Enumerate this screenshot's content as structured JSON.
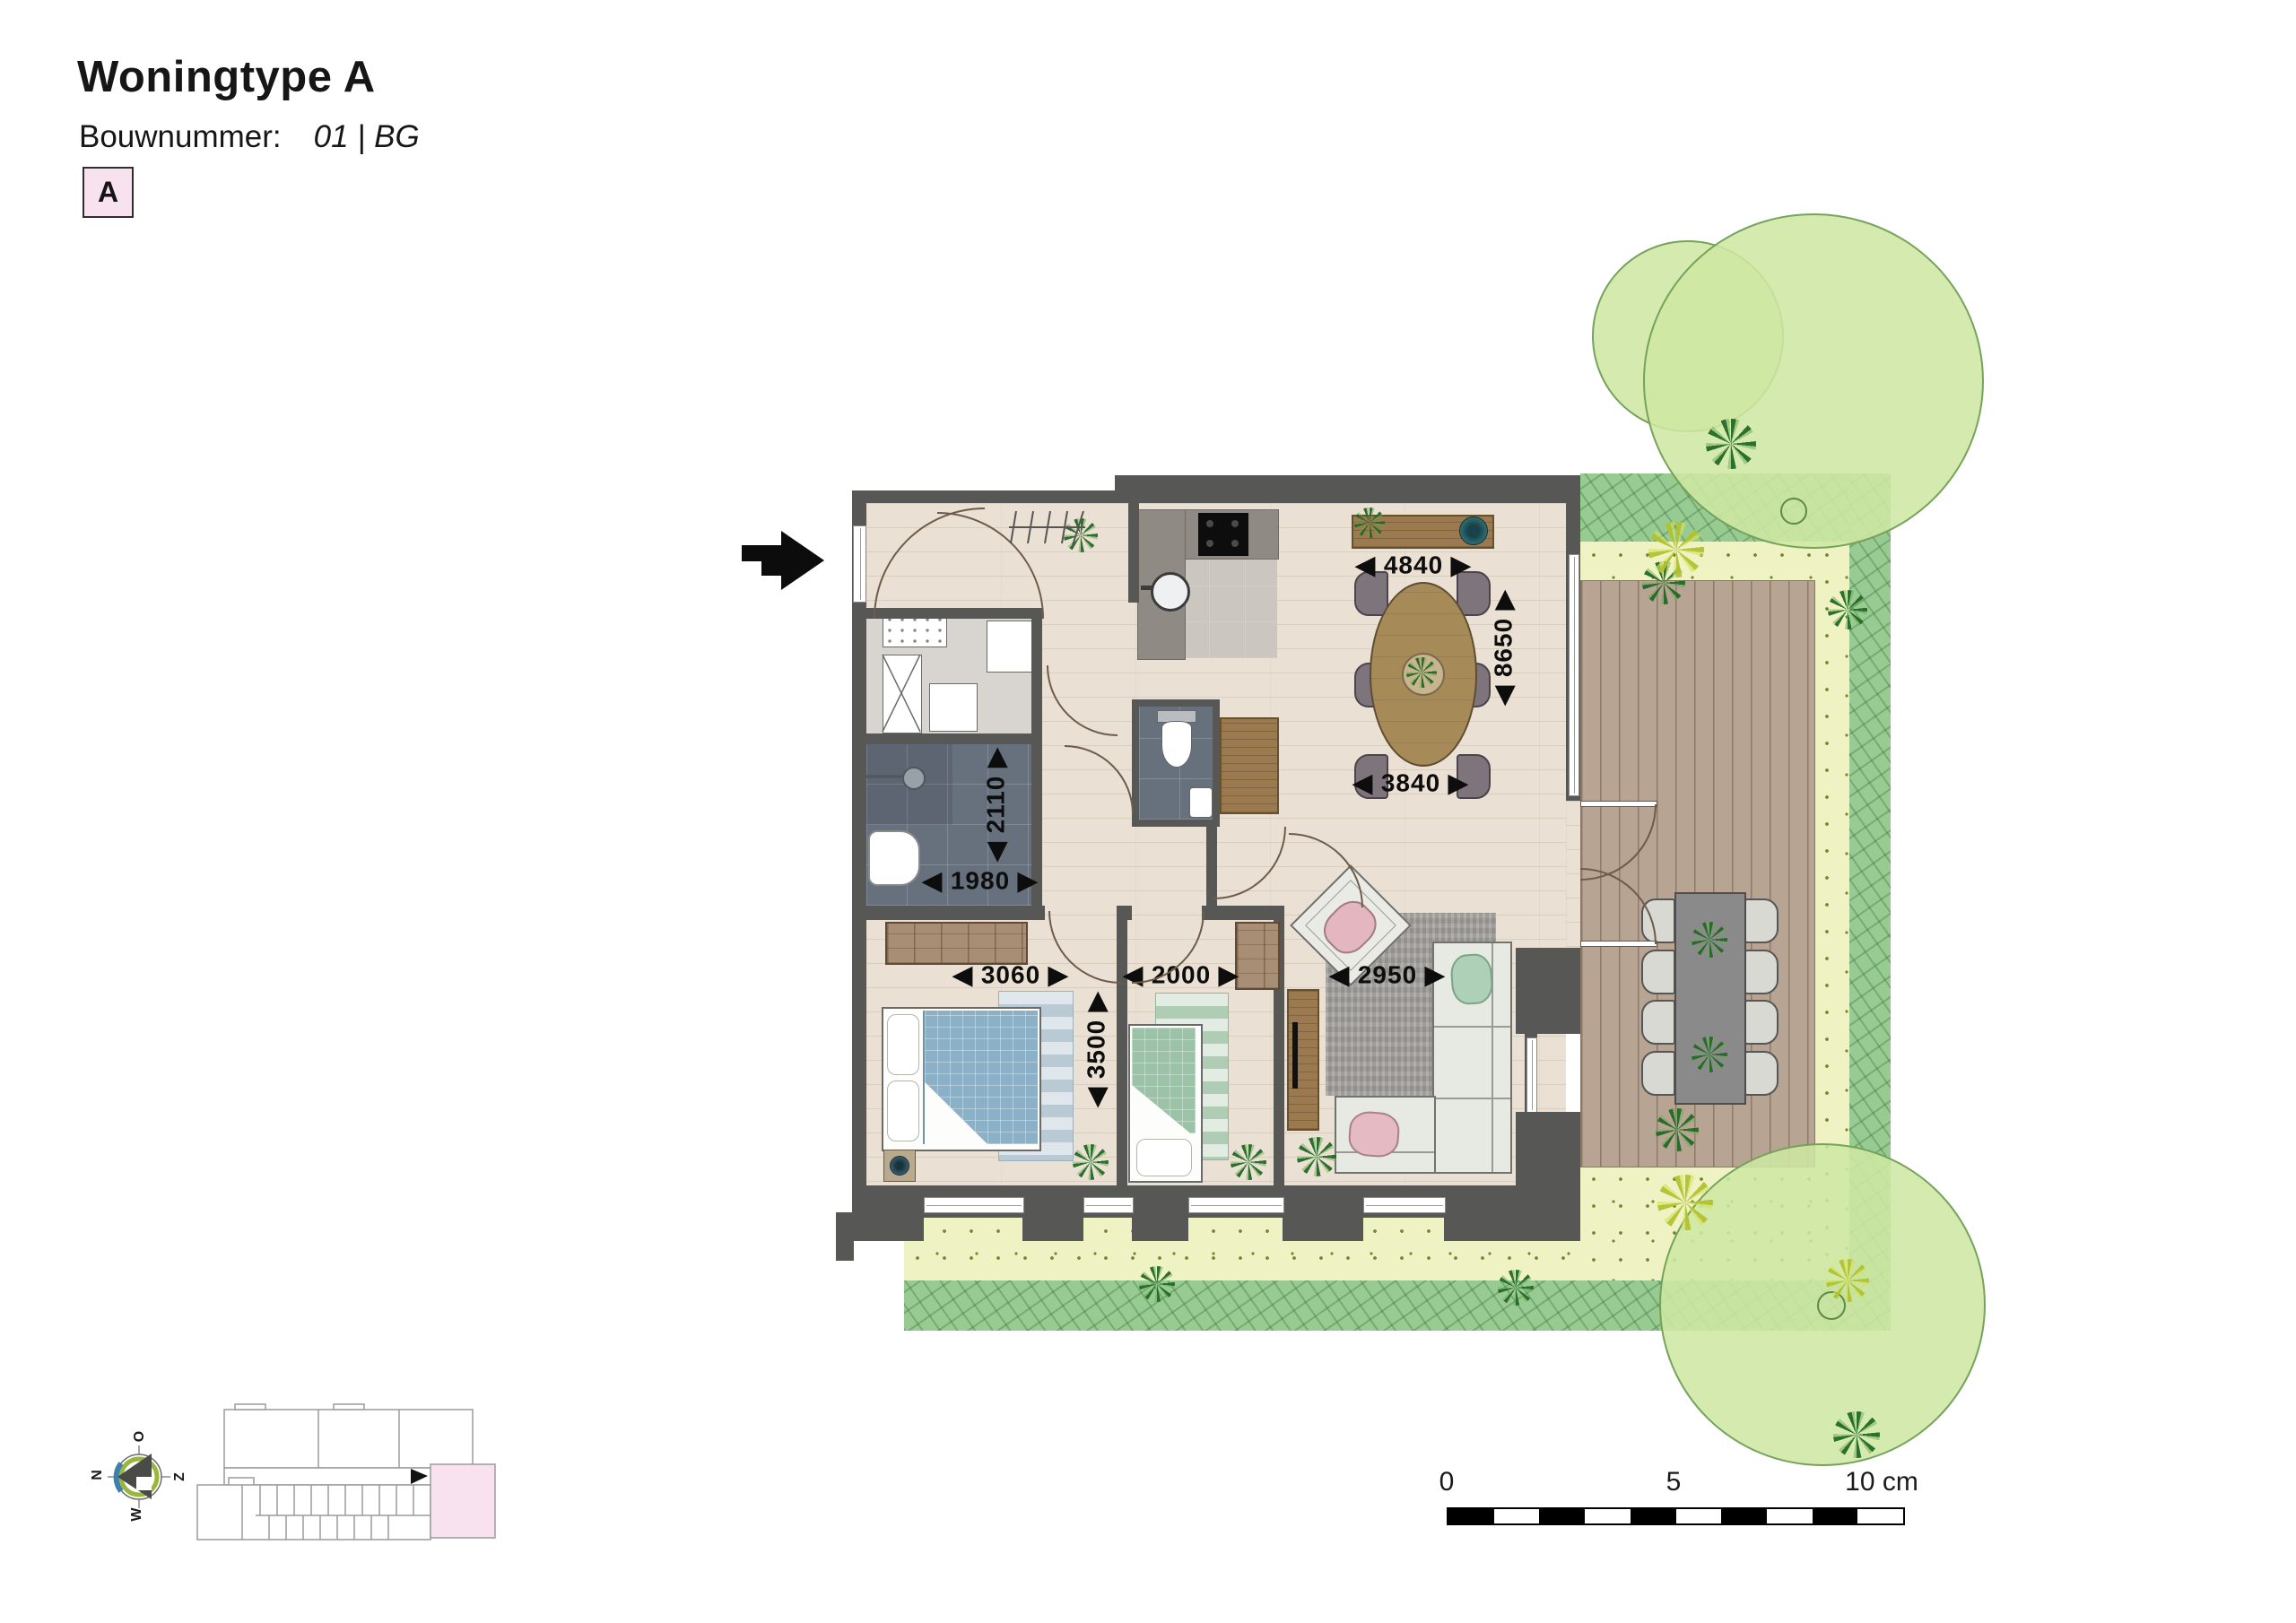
{
  "header": {
    "title": "Woningtype A",
    "bouwnummer_label": "Bouwnummer:",
    "bouwnummer_value": "01 | BG",
    "badge_letter": "A"
  },
  "plan": {
    "dimensions": {
      "dining_width": "◀ 4840 ▶",
      "dining_depth": "◀ 8650 ▶",
      "dining_width_inner": "◀ 3840 ▶",
      "bathroom_depth": "◀ 2110 ▶",
      "bathroom_width": "◀ 1980 ▶",
      "bedroom1_width": "◀ 3060 ▶",
      "bedroom2_width": "◀ 2000 ▶",
      "bedroom1_depth": "◀ 3500 ▶",
      "living_width": "◀ 2950 ▶"
    }
  },
  "compass": {
    "top": "O",
    "left": "N",
    "right": "Z",
    "bottom": "W"
  },
  "scale_bar": {
    "start": "0",
    "middle": "5",
    "end": "10 cm"
  },
  "colors": {
    "wall": "#575756",
    "wood_floor": "#eae1d4",
    "tile_floor": "#67717e",
    "kitchen_floor": "#cbc7c0",
    "deck": "#b7a492",
    "lawn": "#eff3c4",
    "hedge": "#97cb92",
    "tree": "#cfe7a3",
    "accent_pink": "#f8e2f0",
    "table_wood": "#a68b58",
    "bed_blue": "#8cb1c7",
    "bed_green": "#9cc2a8",
    "scale_black": "#000000"
  }
}
